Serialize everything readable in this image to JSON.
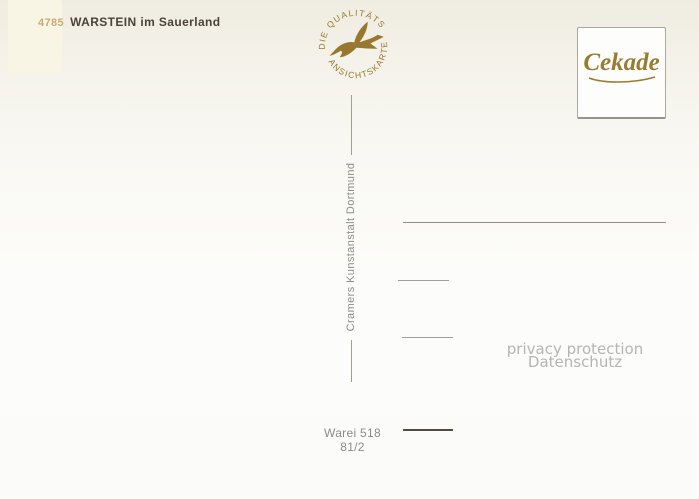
{
  "page": {
    "background_top": "#efede1",
    "background_bottom": "#fcfcfa"
  },
  "header": {
    "postal_code": "4785",
    "postal_code_color": "#c6ad74",
    "title": "WARSTEIN im Sauerland",
    "title_color": "#4a4338"
  },
  "quality_seal": {
    "top_text": "DIE QUALITÄTS",
    "bottom_text": "ANSICHTSKARTE",
    "icon": "swallow-icon",
    "color": "#97782e"
  },
  "stamp_box": {
    "brand": "Cekade",
    "brand_color": "#9a7b33",
    "border_color": "#aaa89d"
  },
  "spine": {
    "publisher": "Cramers Kunstanstalt Dortmund",
    "color": "#8d8d88"
  },
  "watermark": {
    "line1": "privacy protection",
    "line2": "Datenschutz",
    "color": "#b5b5b2"
  },
  "imprint": {
    "reference": "Warei 518",
    "code": "81/2",
    "color": "#8c8c87"
  }
}
